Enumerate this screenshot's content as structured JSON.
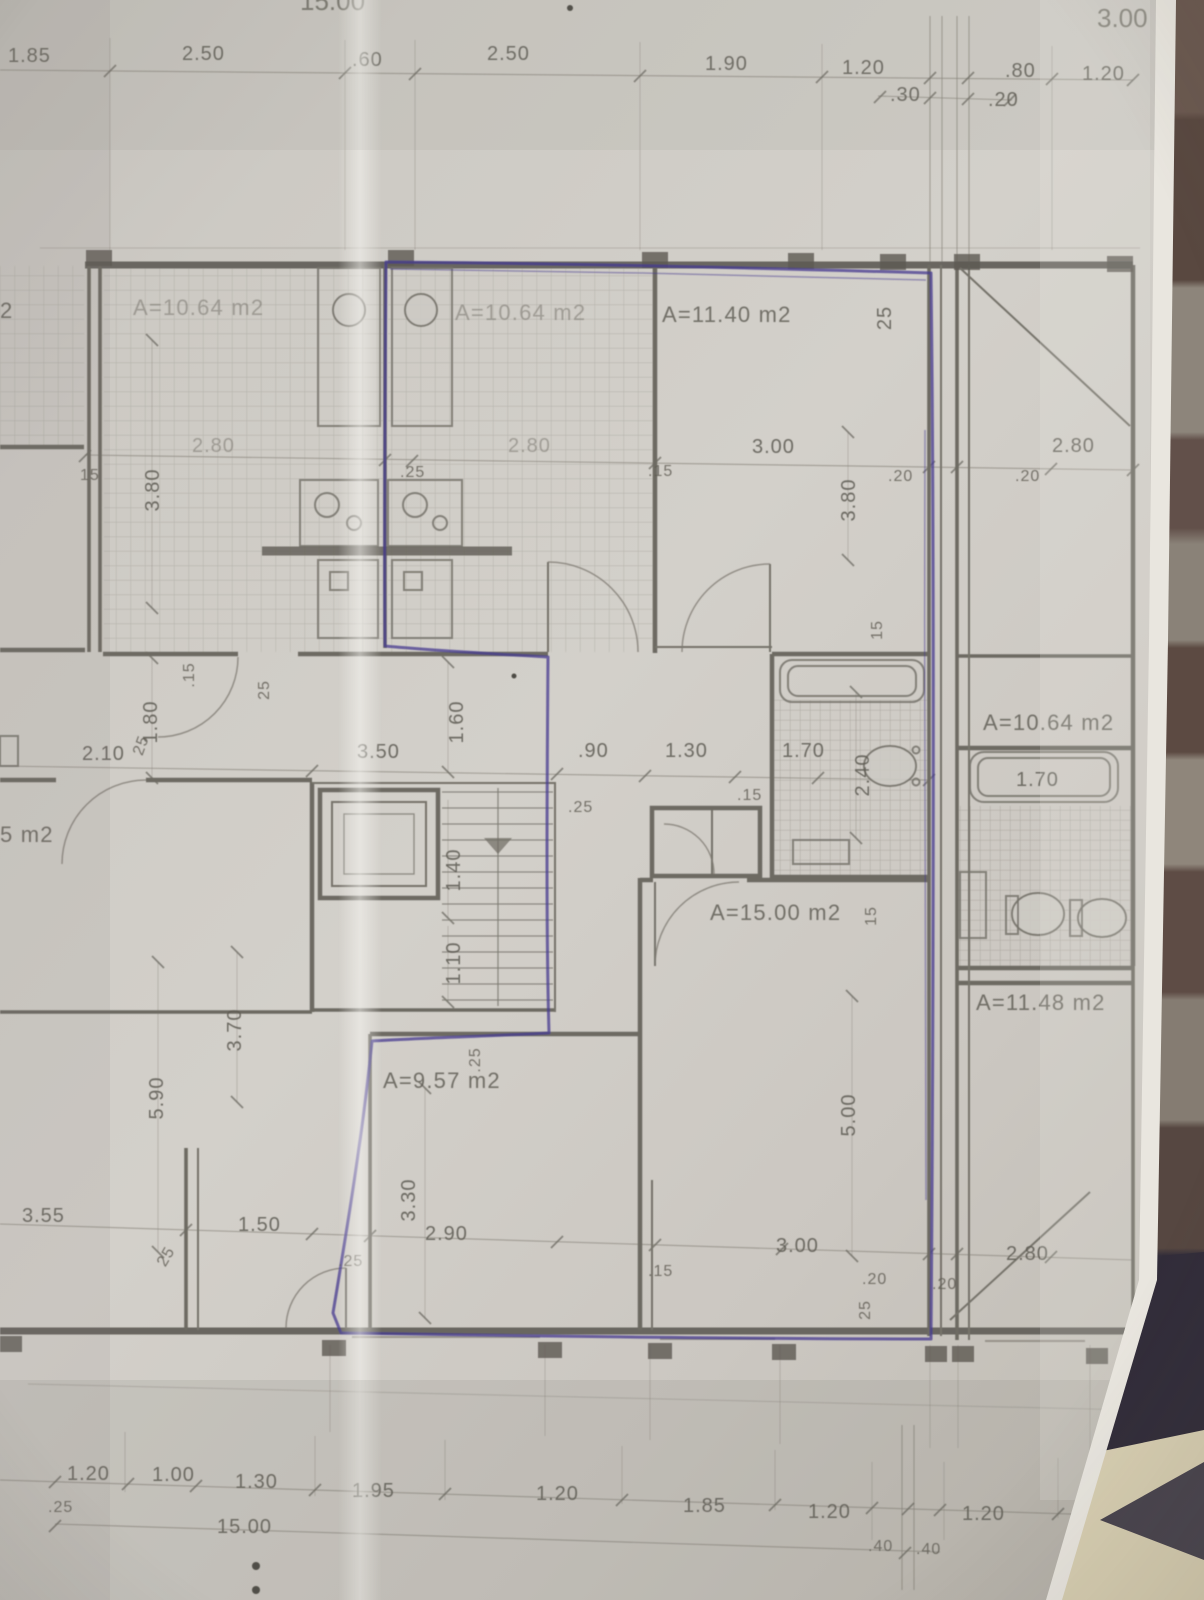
{
  "photo": {
    "description": "hand-annotated architectural floor plan photographed on striped fabric",
    "paper_color": "#cdcac4",
    "pencil_color": "#6e6b63",
    "annotation_ink_color": "#463b90",
    "fabric_brown": "#5e4c44",
    "fabric_stripe": "#8d857b",
    "fabric_dark": "#322d3a",
    "fabric_cream": "#d8cfb2"
  },
  "room_areas": {
    "kitchen_left": "A=10.64 m2",
    "kitchen_middle": "A=10.64 m2",
    "room_top_right": "A=11.40 m2",
    "room_right": "A=10.64 m2",
    "living_room": "A=15.00 m2",
    "room_bottom_left": "A=9.57 m2",
    "room_bottom_right": "A=11.48 m2",
    "room_left_edge_partial": "5 m2",
    "room_left_edge_cut": "2"
  },
  "dims_top": [
    "1.85",
    "2.50",
    ".60",
    "2.50",
    "1.90",
    "1.20",
    ".30",
    ".80",
    ".20",
    "1.20",
    "3.00",
    "15.00"
  ],
  "dims_mid": [
    "2.80",
    ".25",
    "2.80",
    ".15",
    "3.00",
    ".20",
    ".20",
    "2.80",
    "15",
    "3.80",
    "3.80",
    "25"
  ],
  "dims_hall": [
    "2.10",
    "3.50",
    ".90",
    "1.30",
    "1.70",
    ".25",
    ".15",
    "2.40",
    ".15",
    "25",
    "1.80",
    "25",
    "1.60",
    "1.40",
    "1.10",
    "15",
    "15",
    "1.70"
  ],
  "dims_lower": [
    "5.90",
    "3.70",
    "5.00",
    ".25",
    "3.30",
    "3.55",
    "25",
    "1.50",
    ".25",
    "2.90",
    ".15",
    "3.00",
    ".20",
    ".20",
    "2.80",
    "25"
  ],
  "dims_bottom": [
    "1.20",
    ".25",
    "1.00",
    "1.30",
    "1.95",
    "1.20",
    "1.85",
    "1.20",
    ".40",
    ".40",
    "1.20",
    "15.00"
  ]
}
